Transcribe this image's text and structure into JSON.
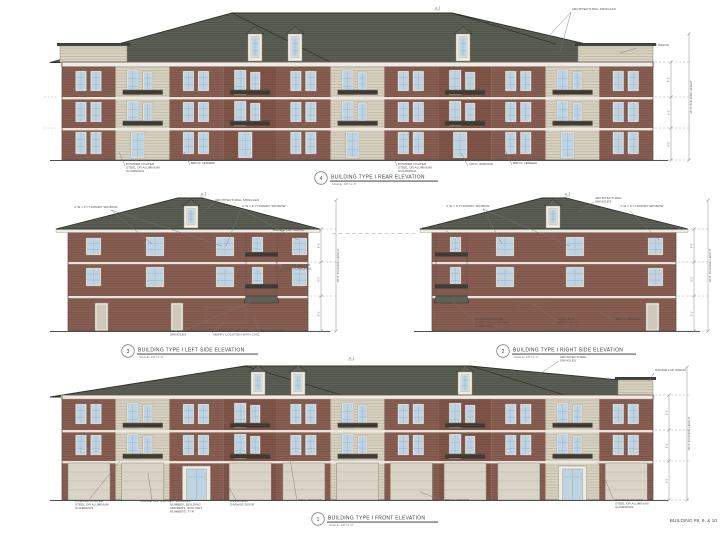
{
  "sheet": {
    "background": "#ffffff",
    "corner_label": "BUILDING #8, 9, & 10"
  },
  "colors": {
    "roof": "#5d6156",
    "roof_edge": "#2e3129",
    "cap_band": "#3c4037",
    "brick_a": "#8a5f53",
    "brick_b": "#815649",
    "siding": "#d8d2c1",
    "trim": "#edebe2",
    "glass": "#bfd4e2",
    "muntin": "#8fa9bb",
    "railing": "#3f3a33",
    "garage": "#dad4c7",
    "garage_line": "#b7b1a4",
    "outline": "#5d4c44",
    "ground": "#4e4e4e",
    "annotation": "#4a4a4a",
    "leader": "#787878",
    "dim": "#8a8a8a",
    "label_text": "#3f3f3f"
  },
  "drawing_labels": {
    "scale_note": "SCALE: 1/8\"=1'-0\""
  },
  "dimensions": {
    "building_height": "38'-0\" BUILDING HEIGHT",
    "floor_height": "9'-1\"",
    "pitch": "12"
  },
  "elevations": {
    "rear": {
      "number": "4",
      "title": "BUILDING TYPE I REAR ELEVATION",
      "annotations": [
        "ARCHITECTURAL SHINGLES",
        "HARDIE LAP SIDING",
        "POWDER COATED\nSTEEL OR ALUMINUM\nGUARDRAIL",
        "BRICK VENEER",
        "POWDER COATED\nSTEEL OR ALUMINUM\nGUARDRAIL",
        "VINYL WINDOW",
        "BRICK VENEER"
      ]
    },
    "left": {
      "number": "3",
      "title": "BUILDING TYPE I LEFT SIDE ELEVATION",
      "annotations": [
        "4' W x 5' H DUMMY WINDOW",
        "ARCHITECTURAL SHINGLES",
        "4' W x 5' H DUMMY WINDOW",
        "HARDIE LAP SIDING",
        "POWDER COATED\nSTEEL GUARDRAIL",
        "ARCHITECTURAL\nSHINGLES",
        "ELECTRICAL SERVICE -\nVERIFY LOCATION WITH CIVIL",
        "BRICK VENEER"
      ]
    },
    "right": {
      "number": "2",
      "title": "BUILDING TYPE I RIGHT SIDE ELEVATION",
      "annotations": [
        "4' W x 5' H DUMMY WINDOW",
        "ARCHITECTURAL\nSHINGLES",
        "4' W x 5' H DUMMY WINDOW",
        "HARDIE LAP SIDING",
        "POWDER COATED\nSTEEL OR ALUMINUM\nGUARDRAIL",
        "4' W x 5' H\nBRICK INLAY",
        "BRICK VENEER"
      ]
    },
    "front": {
      "number": "1",
      "title": "BUILDING TYPE I FRONT ELEVATION",
      "annotations": [
        "ARCHITECTURAL\nSHINGLES",
        "POWDER COATED\nSTEEL OR ALUMINUM\nGUARDRAIL",
        "HARDIE LAP SIDING",
        "LIT BUILDING\nNUMBER, BUILDING\nADDRESS, AND UNIT\nNUMBERS, TYP.",
        "OVERHEAD\nGARAGE DOOR",
        "VINYL WINDOW",
        "BRICK VENEER",
        "POWDER COATED\nSTEEL OR ALUMINUM\nGUARDRAIL",
        "HARDIE LAP SIDING"
      ]
    }
  }
}
